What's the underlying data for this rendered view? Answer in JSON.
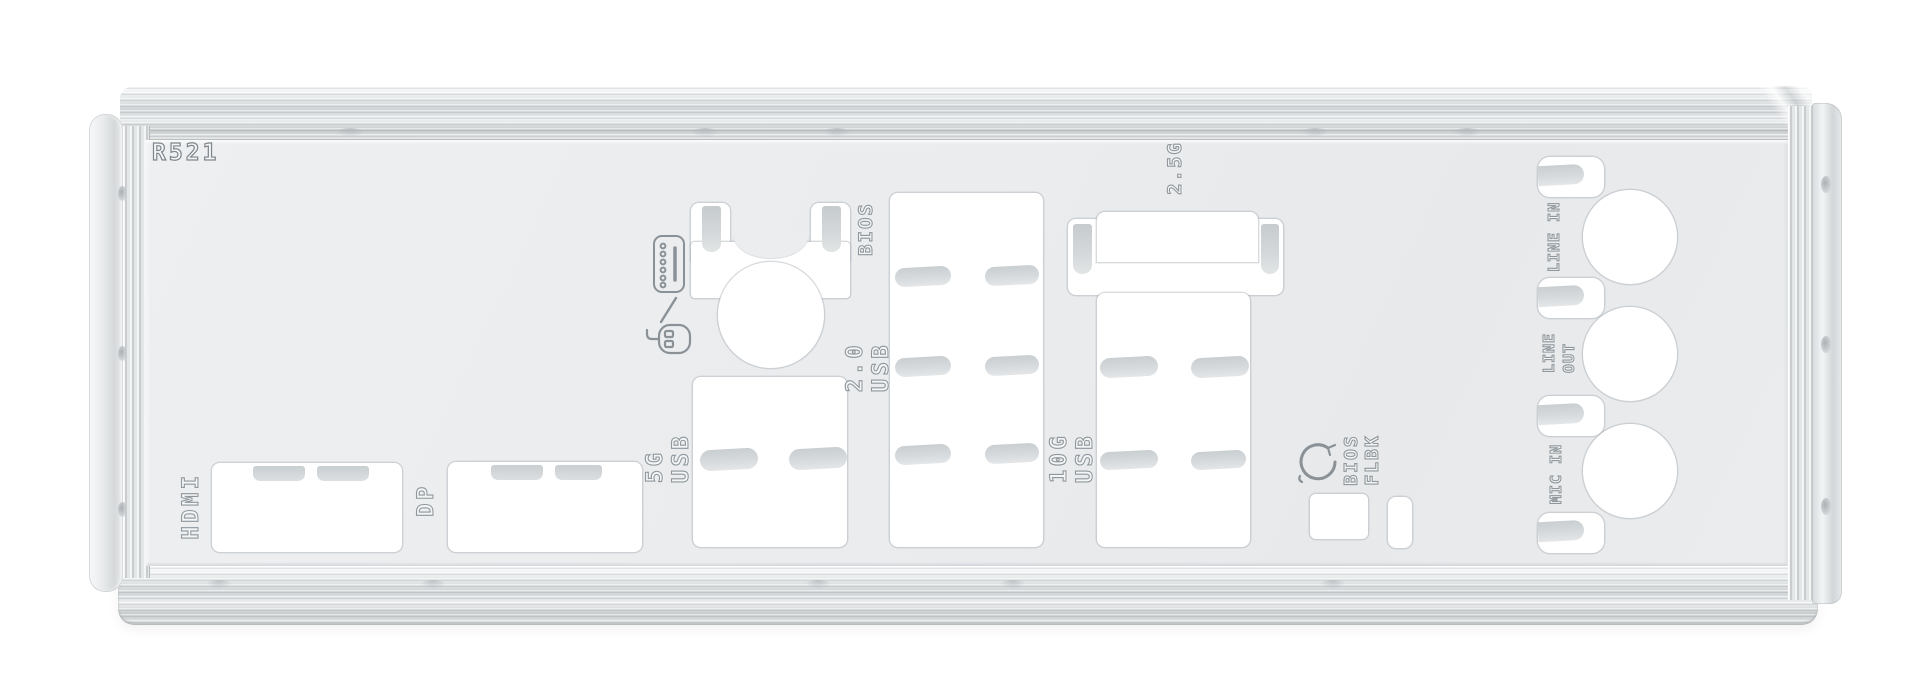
{
  "scene": {
    "description": "Product photo of a white/silver motherboard rear I/O shield plate with stamped port cutouts, bent spring tabs and engraved port labels on a pure white background",
    "background_color": "#ffffff"
  },
  "plate": {
    "embossed_code": "R521",
    "face_color": "#eaecee",
    "rail_color": "#d8dbdd",
    "cutout_color": "#ffffff",
    "tab_color": "#d2d6d9",
    "engraving_color": "#8f979c"
  },
  "labels": {
    "code": "R521",
    "hdmi": "HDMI",
    "dp": "DP",
    "usb_5g": {
      "line1": "5G",
      "line2": "USB"
    },
    "ps2_bios": "BIOS",
    "usb_20": {
      "line1": "2.0",
      "line2": "USB"
    },
    "usb_10g": {
      "line1": "10G",
      "line2": "USB"
    },
    "lan_25g": "2.5G",
    "bios_flashback": {
      "line1": "BIOS",
      "line2": "FLBK"
    },
    "line_in": "LINE IN",
    "line_out": {
      "line1": "LINE",
      "line2": "OUT"
    },
    "mic_in": "MIC IN"
  },
  "icons": [
    {
      "name": "ps2-keyboard-icon"
    },
    {
      "name": "slash-separator-icon"
    },
    {
      "name": "ps2-mouse-icon"
    },
    {
      "name": "bios-flashback-arrow-icon"
    }
  ],
  "cutouts": [
    "HDMI rectangular cutout",
    "DisplayPort rectangular cutout",
    "5G USB stacked-port cutout",
    "PS/2 round combo cutout with two tab slots",
    "USB 2.0 tall stacked-port cutout",
    "2.5G LAN over 10G USB combo cutout",
    "BIOS FlashBack USB cutout",
    "BIOS FlashBack button slot",
    "three round audio jack holes",
    "four audio spring-tab slots"
  ]
}
